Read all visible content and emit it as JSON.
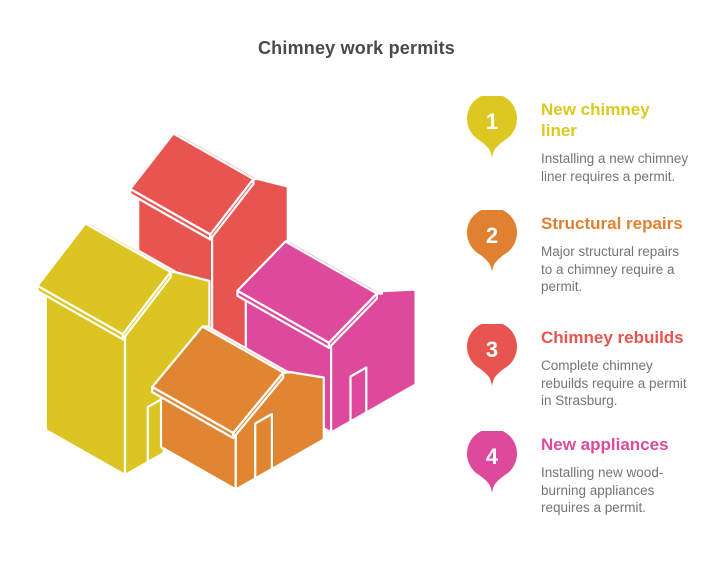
{
  "title": "Chimney work permits",
  "colors": {
    "background": "#ffffff",
    "title_text": "#4a4a4a",
    "body_text": "#757575",
    "pin_number_text": "#ffffff"
  },
  "illustration": {
    "name": "isometric-houses",
    "houses": {
      "red": "#e85450",
      "yellow": "#dcc522",
      "magenta": "#dd4a9c",
      "orange": "#e08632"
    }
  },
  "items": [
    {
      "number": "1",
      "color": "#ddc721",
      "title": "New chimney\nliner",
      "description": "Installing a new chimney\nliner requires a permit."
    },
    {
      "number": "2",
      "color": "#df8131",
      "title": "Structural repairs",
      "description": "Major structural repairs\nto a chimney require a\npermit."
    },
    {
      "number": "3",
      "color": "#e8544f",
      "title": "Chimney rebuilds",
      "description": "Complete chimney\nrebuilds require a permit\nin Strasburg."
    },
    {
      "number": "4",
      "color": "#dd4a9c",
      "title": "New appliances",
      "description": "Installing new wood-\nburning appliances\nrequires a permit."
    }
  ]
}
